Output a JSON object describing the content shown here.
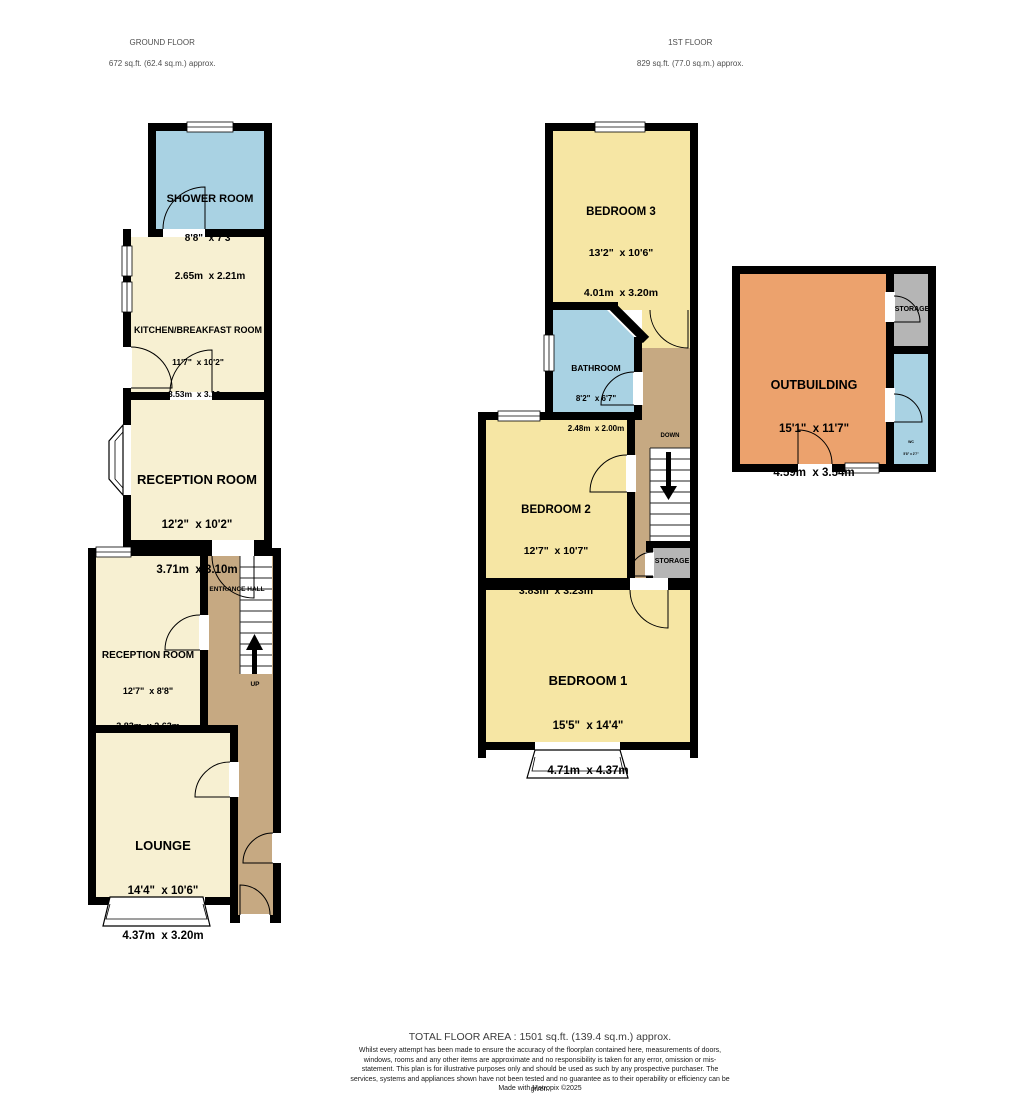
{
  "headers": {
    "ground_floor": {
      "title": "GROUND FLOOR",
      "area": "672 sq.ft. (62.4 sq.m.) approx."
    },
    "first_floor": {
      "title": "1ST FLOOR",
      "area": "829 sq.ft. (77.0 sq.m.) approx."
    }
  },
  "rooms": {
    "shower_room": {
      "name": "SHOWER ROOM",
      "imperial": "8'8\"  x 7'3\"",
      "metric": "2.65m  x 2.21m"
    },
    "kitchen": {
      "name": "KITCHEN/BREAKFAST ROOM",
      "imperial": "11'7\"  x 10'2\"",
      "metric": "3.53m  x 3.10m"
    },
    "reception_room_1": {
      "name": "RECEPTION ROOM",
      "imperial": "12'2\"  x 10'2\"",
      "metric": "3.71m  x 3.10m"
    },
    "reception_room_2": {
      "name": "RECEPTION ROOM",
      "imperial": "12'7\"  x 8'8\"",
      "metric": "3.83m  x 2.63m"
    },
    "lounge": {
      "name": "LOUNGE",
      "imperial": "14'4\"  x 10'6\"",
      "metric": "4.37m  x 3.20m"
    },
    "bedroom_3": {
      "name": "BEDROOM 3",
      "imperial": "13'2\"  x 10'6\"",
      "metric": "4.01m  x 3.20m"
    },
    "bathroom": {
      "name": "BATHROOM",
      "imperial": "8'2\"  x 6'7\"",
      "metric": "2.48m  x 2.00m"
    },
    "bedroom_2": {
      "name": "BEDROOM 2",
      "imperial": "12'7\"  x 10'7\"",
      "metric": "3.83m  x 3.23m"
    },
    "bedroom_1": {
      "name": "BEDROOM 1",
      "imperial": "15'5\"  x 14'4\"",
      "metric": "4.71m  x 4.37m"
    },
    "outbuilding": {
      "name": "OUTBUILDING",
      "imperial": "15'1\"  x 11'7\"",
      "metric": "4.59m  x 3.54m"
    },
    "wc": {
      "name": "WC",
      "imperial": "5'8\" x 2'7\"",
      "metric": "1.73m x 0.79m"
    }
  },
  "labels": {
    "entrance_hall": "ENTRANCE HALL",
    "up": "UP",
    "down": "DOWN",
    "storage_first_floor": "STORAGE",
    "storage_outbuilding": "STORAGE"
  },
  "footer": {
    "total": "TOTAL FLOOR AREA : 1501 sq.ft. (139.4 sq.m.) approx.",
    "disclaimer": "Whilst every attempt has been made to ensure the accuracy of the floorplan contained here, measurements of doors, windows, rooms and any other items are approximate and no responsibility is taken for any error, omission or mis-statement. This plan is for illustrative purposes only and should be used as such by any prospective purchaser. The services, systems and appliances shown have not been tested and no guarantee as to their operability or efficiency can be given.",
    "credit": "Made with Metropix ©2025"
  },
  "colors": {
    "room_cream": "#f7f0d2",
    "room_yellow": "#f6e6a4",
    "room_blue": "#a9d2e3",
    "hall_tan": "#c6a982",
    "outbuilding_orange": "#eca26d",
    "storage_grey": "#b5b5b5",
    "wall_black": "#000000"
  }
}
